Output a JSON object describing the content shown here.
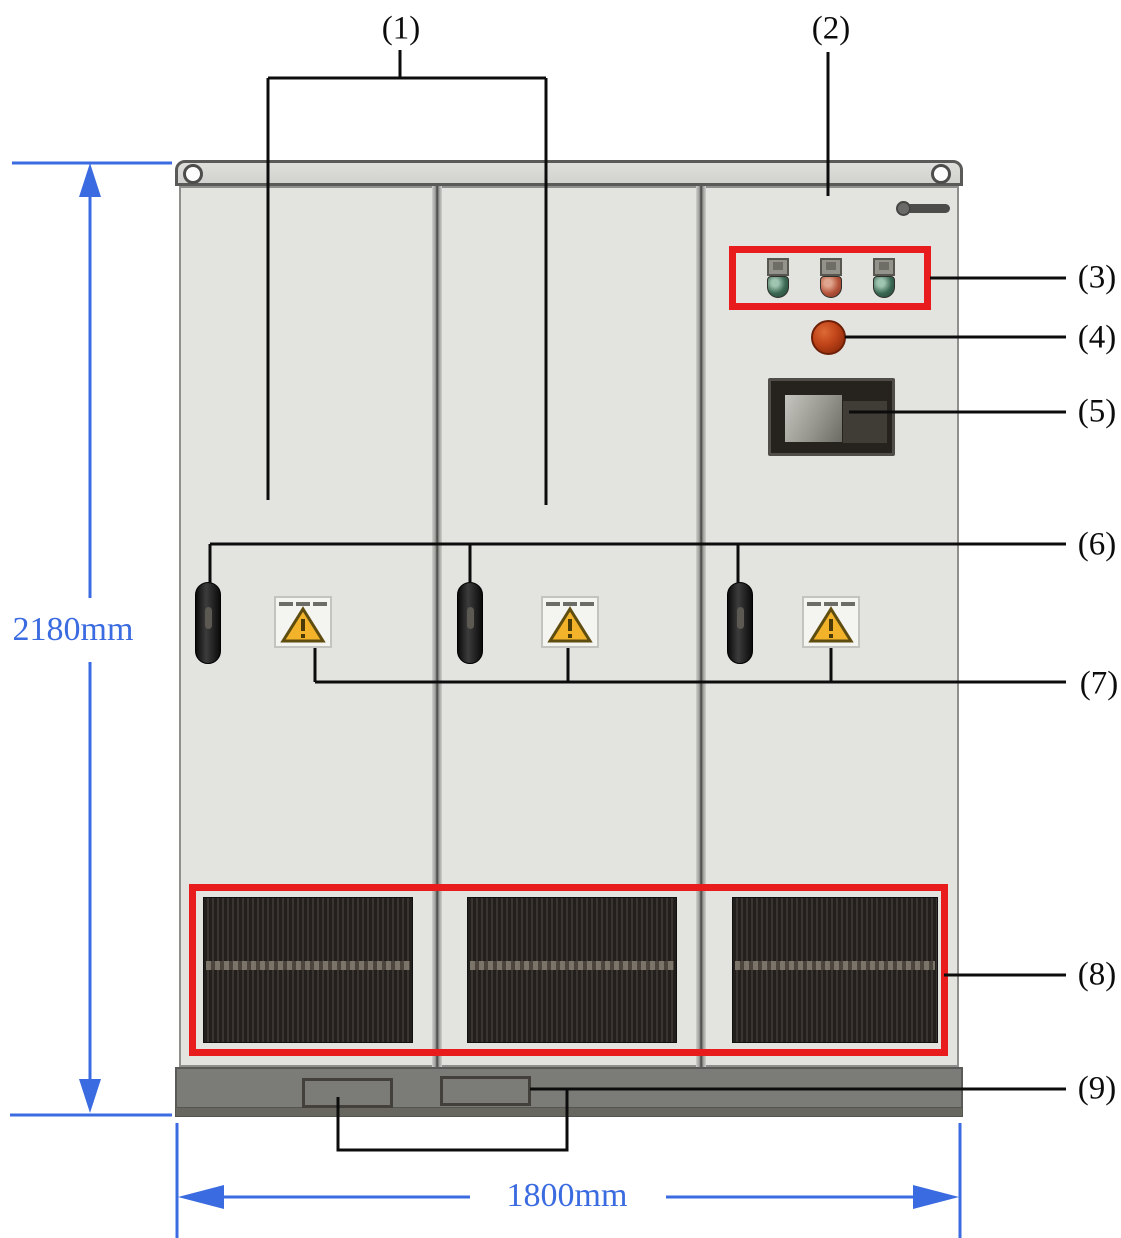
{
  "diagram": {
    "subject": "power-cabinet-front-view",
    "dimensions": {
      "height_label": "2180mm",
      "width_label": "1800mm"
    },
    "callouts": [
      "(1)",
      "(2)",
      "(3)",
      "(4)",
      "(5)",
      "(6)",
      "(7)",
      "(8)",
      "(9)"
    ],
    "colors": {
      "dimension_blue": "#3b6be0",
      "callout_highlight_red": "#e81c1c",
      "cabinet_gray": "#e3e3e0",
      "base_gray": "#7b7b77",
      "indicator_green": "#3a6852",
      "indicator_red": "#b5543a",
      "estop_red": "#bf4318",
      "warning_yellow": "#f2b32a"
    },
    "icons": [
      "lifting-hole-icon",
      "brand-logo-icon",
      "indicator-light-icon",
      "emergency-stop-icon",
      "hmi-display-icon",
      "door-handle-icon",
      "warning-triangle-icon",
      "ventilation-grille-icon",
      "cable-entry-icon"
    ]
  }
}
